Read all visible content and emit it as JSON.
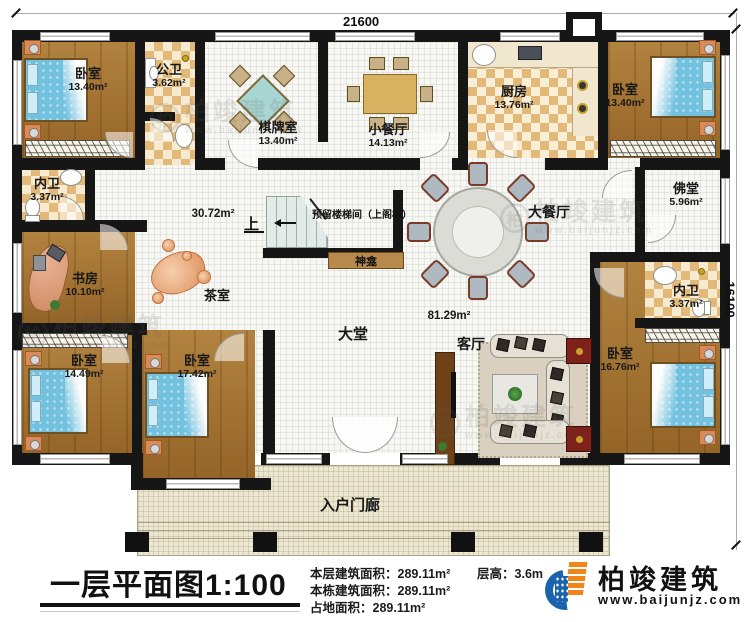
{
  "dimensions": {
    "width_mm": "21600",
    "height_mm": "16100"
  },
  "rooms": {
    "bedroom_tl": {
      "name": "卧室",
      "area": "13.40m²"
    },
    "public_bath": {
      "name": "公卫",
      "area": "3.62m²"
    },
    "chess_room": {
      "name": "棋牌室",
      "area": "13.40m²"
    },
    "small_dining": {
      "name": "小餐厅",
      "area": "14.13m²"
    },
    "kitchen": {
      "name": "厨房",
      "area": "13.76m²"
    },
    "bedroom_tr": {
      "name": "卧室",
      "area": "13.40m²"
    },
    "inner_bath_left": {
      "name": "内卫",
      "area": "3.37m²"
    },
    "buddha_hall": {
      "name": "佛堂",
      "area": "5.96m²"
    },
    "study": {
      "name": "书房",
      "area": "10.10m²"
    },
    "hall_west": {
      "area": "30.72m²"
    },
    "tea_room": {
      "name": "茶室"
    },
    "staircase": {
      "name": "预留楼梯间（上阁楼）",
      "direction": "上"
    },
    "shrine": {
      "name": "神龛"
    },
    "large_dining": {
      "name": "大餐厅"
    },
    "grand_hall": {
      "name": "大堂"
    },
    "open_area": {
      "area": "81.29m²"
    },
    "living_room": {
      "name": "客厅"
    },
    "bedroom_bl1": {
      "name": "卧室",
      "area": "14.49m²"
    },
    "bedroom_bl2": {
      "name": "卧室",
      "area": "17.42m²"
    },
    "inner_bath_right": {
      "name": "内卫",
      "area": "3.37m²"
    },
    "bedroom_br": {
      "name": "卧室",
      "area": "16.76m²"
    },
    "porch": {
      "name": "入户门廊"
    }
  },
  "footer": {
    "title": "一层平面图1:100",
    "stats": [
      {
        "label": "本层建筑面积：",
        "value": "289.11m²"
      },
      {
        "label": "本栋建筑面积：",
        "value": "289.11m²"
      },
      {
        "label": "占地面积：",
        "value": "289.11m²"
      }
    ],
    "floor_height": {
      "label": "层高：",
      "value": "3.6m"
    },
    "brand": "柏竣建筑",
    "website": "www.baijunjz.com"
  },
  "watermark": {
    "brand": "柏竣建筑",
    "website": "www.baijunjz.com",
    "monogram": "柏"
  },
  "colors": {
    "wall": "#161616",
    "wood_floor": "#a1702e",
    "tile": "#e2b978",
    "bed": "#72c1df",
    "porch": "#ebe7d3",
    "brand_blue": "#1b63ac",
    "brand_orange": "#f08519"
  }
}
